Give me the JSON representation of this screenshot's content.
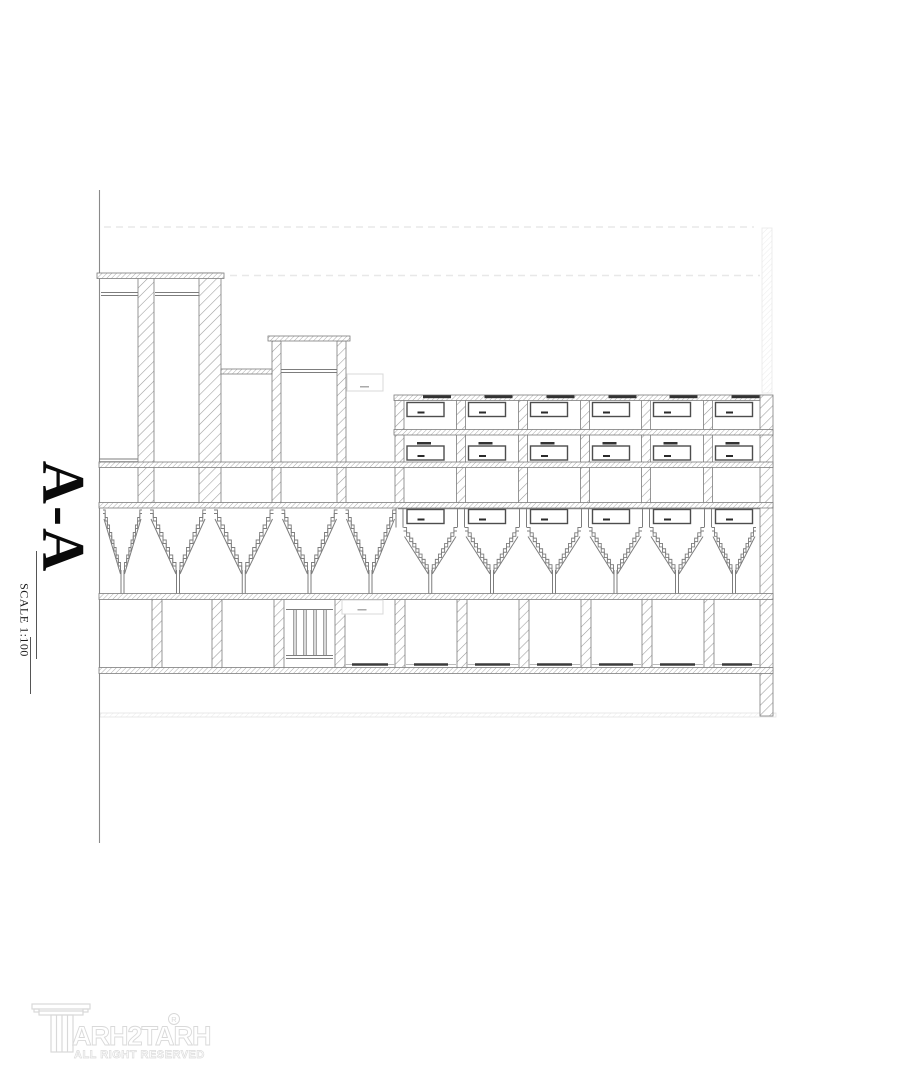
{
  "page": {
    "background": "#ffffff"
  },
  "section": {
    "title": "A-A",
    "scale_label": "SCALE 1:100",
    "type": "building-section-drawing",
    "colors": {
      "line": "#7d7d7d",
      "dark": "#2b2b2b",
      "window_border": "#4d4d4d",
      "hatch_wall": "#9c9c9c",
      "hatch_band": "#a3a3a3",
      "ghost": "#e8e8e8",
      "faint_box": "#d8d8d8",
      "logo_gray": "#d9d9d9"
    },
    "geometry": {
      "boundary": {
        "x": 99.5,
        "y1": 190,
        "y2": 843
      },
      "ghost": {
        "h1": {
          "y": 227,
          "x1": 104,
          "x2": 754
        },
        "h2": {
          "y": 275.5,
          "x1": 230,
          "x2": 760
        },
        "wall": {
          "x": 762,
          "y": 228,
          "w": 10,
          "h": 165
        }
      },
      "tier1": {
        "roof": {
          "x": 97,
          "y": 273,
          "w": 127,
          "h": 5.5
        },
        "ceil_lines": [
          {
            "y": 292.5,
            "x1": 101,
            "x2": 138
          },
          {
            "y": 295.5,
            "x1": 101,
            "x2": 138
          },
          {
            "y": 292.5,
            "x1": 155,
            "x2": 199
          },
          {
            "y": 295.5,
            "x1": 155,
            "x2": 199
          }
        ],
        "walls": [
          {
            "x": 138,
            "y": 273,
            "w": 16,
            "h": 230
          },
          {
            "x": 199,
            "y": 273,
            "w": 22,
            "h": 230
          }
        ]
      },
      "tier2": {
        "roof": {
          "x": 268,
          "y": 336,
          "w": 82,
          "h": 5
        },
        "cols": [
          {
            "x": 272,
            "y": 341,
            "w": 9,
            "h": 162
          },
          {
            "x": 337,
            "y": 341,
            "w": 9,
            "h": 162
          }
        ],
        "band": {
          "x": 221,
          "y": 369,
          "w": 51,
          "h": 5
        },
        "dbl_lines": [
          {
            "y": 369.5,
            "x1": 281,
            "x2": 337
          },
          {
            "y": 372.5,
            "x1": 281,
            "x2": 337
          }
        ]
      },
      "right_building": {
        "roof": {
          "x": 394,
          "y": 395,
          "w": 366,
          "h": 5.5
        },
        "right_wall": {
          "x": 760,
          "y": 395,
          "w": 13,
          "h": 321
        },
        "cols_x": [
          395,
          456.5,
          518.5,
          580.5,
          641.5,
          703.5
        ],
        "col_w": 9,
        "col_y1": 400,
        "col_y2": 503,
        "bay_lefts": [
          404,
          465.5,
          527.5,
          589.5,
          650.5,
          712.5
        ],
        "window_line": {
          "y": 508.8,
          "x1": 398,
          "x2": 760
        }
      },
      "bands": [
        {
          "y": 429.5,
          "x1": 394,
          "x2": 773,
          "h": 5.5
        },
        {
          "y": 462,
          "x1": 99,
          "x2": 773,
          "h": 5.5
        },
        {
          "y": 502.5,
          "x1": 99,
          "x2": 773,
          "h": 5.5
        },
        {
          "y": 593.5,
          "x1": 99,
          "x2": 773,
          "h": 6
        },
        {
          "y": 667.5,
          "x1": 99,
          "x2": 773,
          "h": 6
        }
      ],
      "left_dbl_lines": [
        {
          "y": 459,
          "x1": 99,
          "x2": 138
        },
        {
          "y": 461.8,
          "x1": 99,
          "x2": 138
        }
      ],
      "windows": {
        "rows_y": [
          402.5,
          446,
          509.5
        ],
        "h": 14,
        "offset": 3,
        "w": 37,
        "lintel_row1_y": 395.2,
        "lintel_row2_y": 442
      },
      "stairs": {
        "peaks": [
          99,
          146,
          210,
          277.5,
          341.5,
          399.5,
          461,
          523,
          585,
          646,
          708,
          760
        ],
        "left_top_y": 510,
        "right_top_y": 527.5,
        "bottom_y": 570,
        "support_y2": 593.5,
        "right_start_index": 5,
        "stub_cols": [
          399.5,
          461,
          523,
          585,
          646,
          708
        ],
        "stub_y1": 508,
        "stub_y2": 527.5
      },
      "bottom_cols": {
        "xs": [
          152,
          212,
          274,
          335,
          395,
          457,
          519,
          581,
          642,
          704
        ],
        "w": 10,
        "y1": 599,
        "y2": 668
      },
      "grill": {
        "x1": 286,
        "x2": 333,
        "y_top": 609.5,
        "y_bot1": 655.5,
        "y_bot2": 658.5,
        "bars": [
          295,
          305,
          315,
          325
        ]
      },
      "thresholds": {
        "bays": [
          [
            348,
            392
          ],
          [
            410,
            452
          ],
          [
            471,
            514
          ],
          [
            533,
            576
          ],
          [
            595,
            637
          ],
          [
            656,
            699
          ],
          [
            718,
            756
          ]
        ],
        "y": 664.5
      },
      "label_boxes": [
        {
          "x": 347,
          "y": 374,
          "w": 36,
          "h": 17
        },
        {
          "x": 342,
          "y": 600,
          "w": 41,
          "h": 14
        }
      ],
      "bottom_faint": {
        "x": 100,
        "y": 713,
        "w": 676,
        "h": 4
      },
      "scale_lines": [
        {
          "x": 36.5,
          "y1": 551,
          "y2": 659
        },
        {
          "x": 30.5,
          "y1": 637,
          "y2": 694
        }
      ]
    }
  },
  "logo": {
    "brand_full": "TARH2TARH",
    "brand": "ARH2TARH",
    "registered": "R",
    "tagline": "ALL RIGHT RESERVED"
  }
}
